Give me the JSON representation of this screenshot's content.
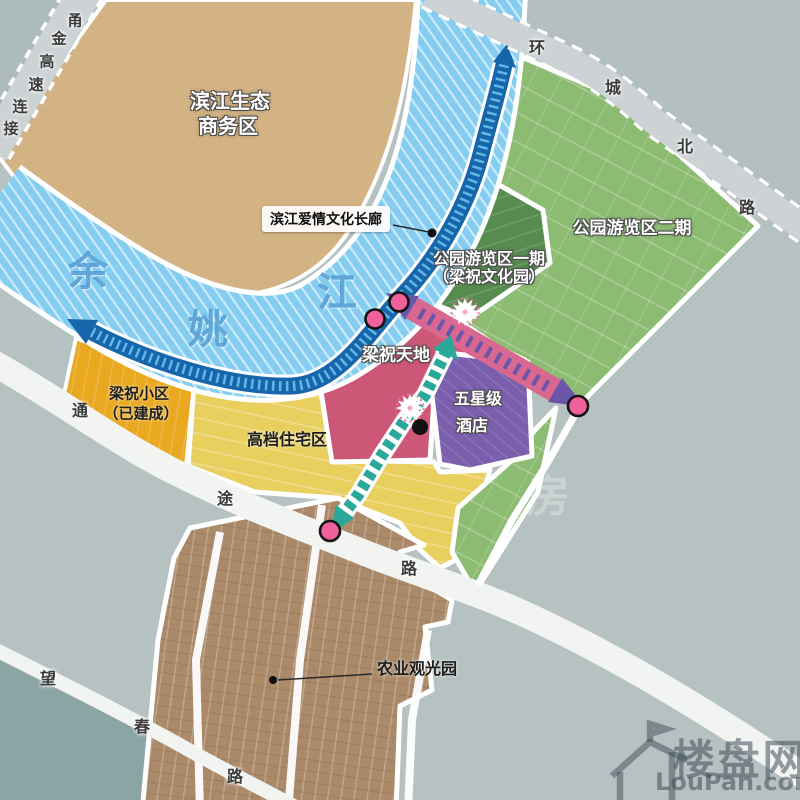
{
  "zones": {
    "business": {
      "label_line1": "滨江生态",
      "label_line2": "商务区"
    },
    "park_phase2": {
      "label": "公园游览区二期"
    },
    "park_phase1": {
      "label_line1": "公园游览区一期",
      "label_line2": "（梁祝文化园）"
    },
    "liangzhu_world": {
      "label": "梁祝天地"
    },
    "hotel": {
      "label_line1": "五星级",
      "label_line2": "酒店"
    },
    "community": {
      "label_line1": "梁祝小区",
      "label_line2": "（已建成）"
    },
    "residential": {
      "label": "高档住宅区"
    },
    "agriculture": {
      "label": "农业观光园"
    }
  },
  "corridor": {
    "label": "滨江爱情文化长廊"
  },
  "river": {
    "name": "余姚江",
    "chars": [
      "余",
      "姚",
      "江"
    ]
  },
  "roads": {
    "yongjin": {
      "name": "甬金高速连接",
      "chars": [
        "甬",
        "金",
        "高",
        "速",
        "连",
        "接"
      ]
    },
    "huancheng": {
      "name": "环城北路",
      "chars": [
        "环",
        "城",
        "北",
        "路"
      ]
    },
    "tongtu": {
      "name": "通途路",
      "chars": [
        "通",
        "途",
        "路"
      ]
    },
    "wangchun": {
      "name": "望春路",
      "chars": [
        "望",
        "春",
        "路"
      ]
    }
  },
  "watermark": {
    "brand": "楼盘网",
    "domain": "LouPan.com",
    "ghost": "房"
  },
  "colors": {
    "bg": "#b6c2c1",
    "bg_ne": "#b3bfc1",
    "bg_sw": "#8ba5a4",
    "bg_w": "#aebbbd",
    "business": "#d3b284",
    "park_phase2": "#8cbb72",
    "park_phase1": "#578c50",
    "green_strip": "#7fae66",
    "residential": "#e8cf5e",
    "community": "#e9a81f",
    "liangzhu_world": "#cc5777",
    "hotel": "#7b5fad",
    "agriculture": "#ab8a6a",
    "river_base": "#85ccf1",
    "river_stripe": "#c9eafa",
    "corridor": "#1766ab",
    "corridor_tick": "#62b7e5",
    "band_pink": "#d8688f",
    "band_purple": "#6a55a8",
    "route_teal": "#2aa99b",
    "node_pink": "#f0609a",
    "road_gray": "#cdd2d4",
    "road_white": "#f2f4f2"
  }
}
